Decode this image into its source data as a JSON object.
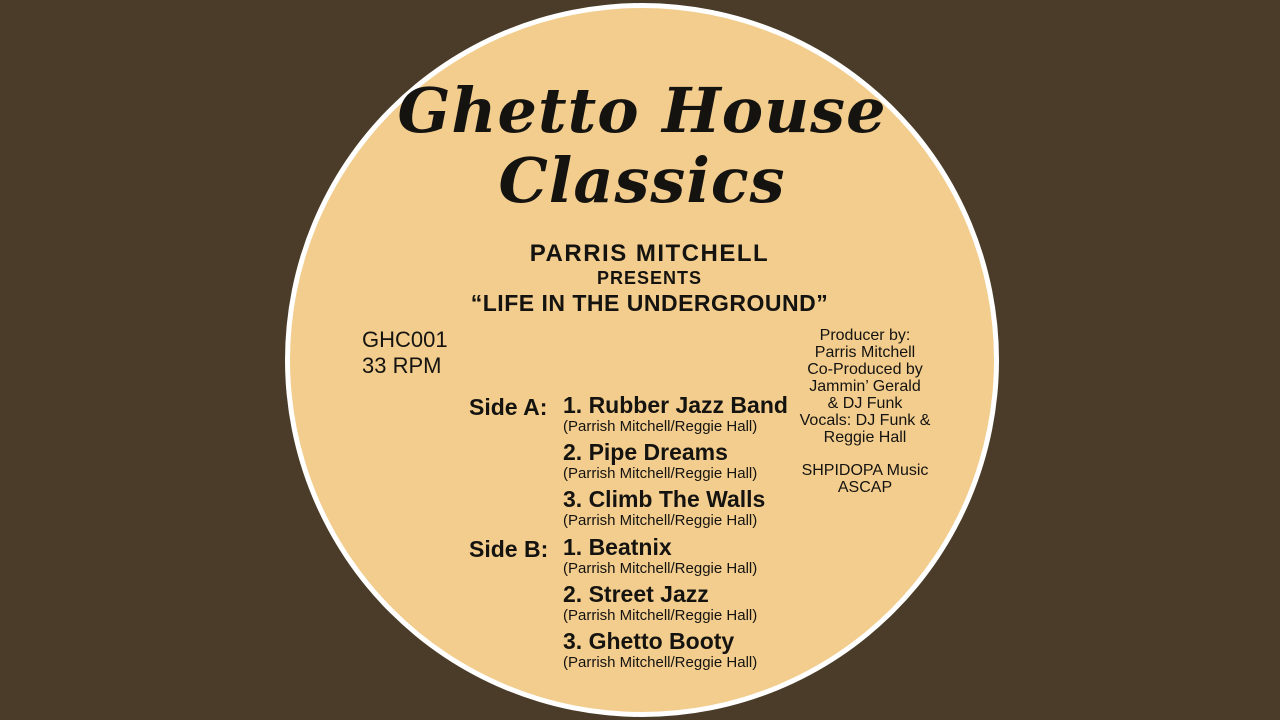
{
  "colors": {
    "background": "#4A3C28",
    "disc": "#F2CD8E",
    "ring": "#FFFFFF",
    "text": "#151310"
  },
  "label": {
    "title_line1": "Ghetto House",
    "title_line2": "Classics",
    "artist": "PARRIS MITCHELL",
    "presents": "PRESENTS",
    "album": "“LIFE IN THE UNDERGROUND”",
    "catalog": "GHC001",
    "speed": "33 RPM",
    "credits_right": [
      "Producer by:",
      "Parris Mitchell",
      "Co-Produced by",
      "Jammin’ Gerald",
      "& DJ Funk",
      "Vocals: DJ Funk &",
      "Reggie Hall"
    ],
    "publishing": [
      "SHPIDOPA Music",
      "ASCAP"
    ],
    "side_a": {
      "label": "Side A:",
      "tracks": [
        {
          "title": "1. Rubber Jazz Band",
          "credit": "(Parrish Mitchell/Reggie Hall)"
        },
        {
          "title": "2. Pipe Dreams",
          "credit": "(Parrish Mitchell/Reggie Hall)"
        },
        {
          "title": "3. Climb The Walls",
          "credit": "(Parrish Mitchell/Reggie Hall)"
        }
      ]
    },
    "side_b": {
      "label": "Side B:",
      "tracks": [
        {
          "title": "1. Beatnix",
          "credit": "(Parrish Mitchell/Reggie Hall)"
        },
        {
          "title": "2. Street Jazz",
          "credit": "(Parrish Mitchell/Reggie Hall)"
        },
        {
          "title": "3. Ghetto Booty",
          "credit": "(Parrish Mitchell/Reggie Hall)"
        }
      ]
    }
  }
}
